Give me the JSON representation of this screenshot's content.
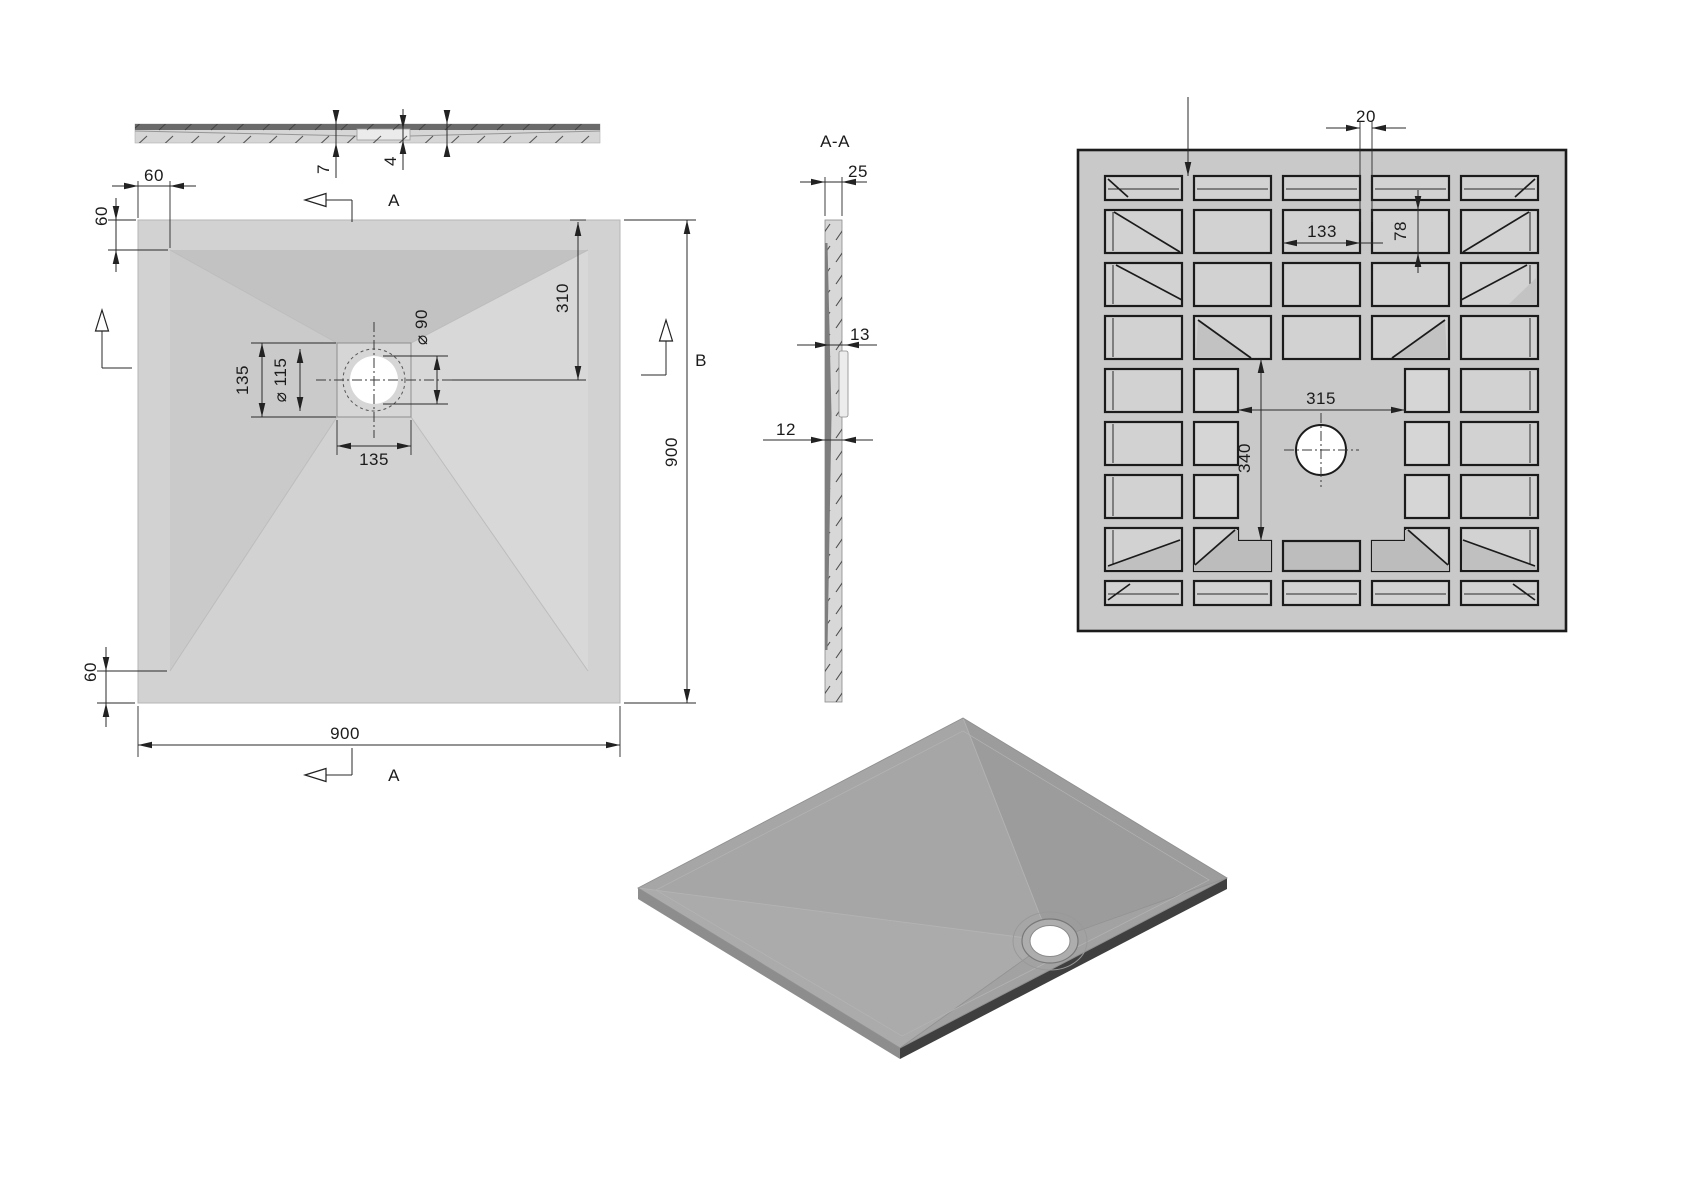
{
  "drawing": {
    "front_view": {
      "dim_lip": "7",
      "dim_recess": "4"
    },
    "plan_view": {
      "dim_edge_offset": "60",
      "dim_drain_box": "135",
      "dim_recess_dia": "⌀ 115",
      "dim_hole_dia": "⌀ 90",
      "dim_drain_from_top": "310",
      "dim_size": "900",
      "label_section_a": "A",
      "label_section_b": "B"
    },
    "section_aa": {
      "title": "A-A",
      "dim_thickness": "25",
      "dim_mid": "13",
      "dim_base": "12"
    },
    "bottom_view": {
      "dim_rib": "20",
      "dim_pocket_w": "133",
      "dim_pocket_h": "78",
      "dim_center_w": "315",
      "dim_center_h": "340"
    }
  },
  "colors": {
    "line": "#1b1b1b",
    "tray_light": "#d2d2d2",
    "tray_shade": "#c2c2c2",
    "pocket_dark": "#bdbdbd",
    "iso_top": "#a4a4a4",
    "iso_dark_edge": "#3f3f3f",
    "hole": "#ffffff"
  }
}
